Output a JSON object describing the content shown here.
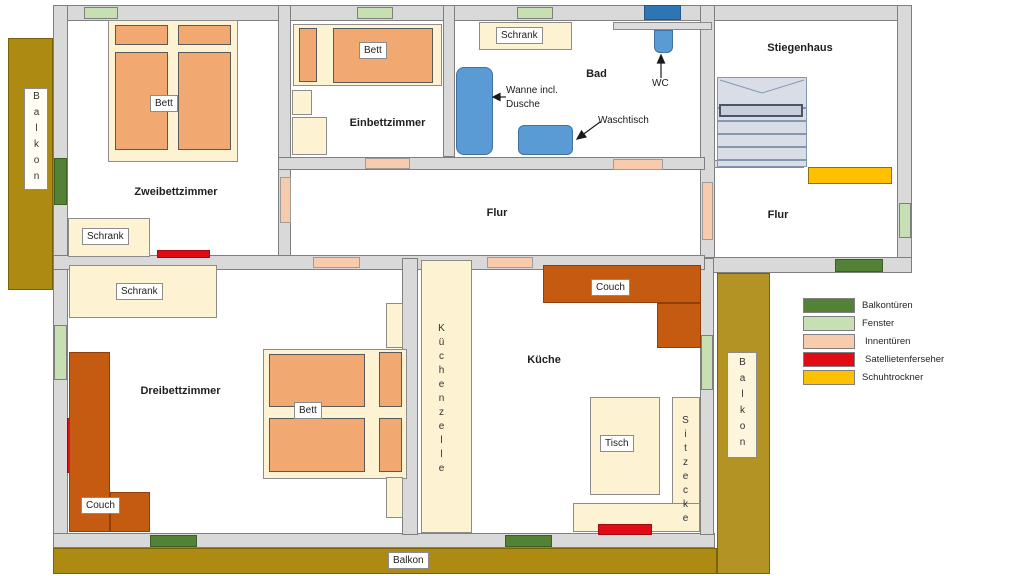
{
  "rooms": {
    "zweibettzimmer": "Zweibettzimmer",
    "einbettzimmer": "Einbettzimmer",
    "bad": "Bad",
    "stiegenhaus": "Stiegenhaus",
    "flur_mitte": "Flur",
    "flur_rechts": "Flur",
    "dreibettzimmer": "Dreibettzimmer",
    "kueche": "Küche"
  },
  "furniture_labels": {
    "bett": "Bett",
    "schrank": "Schrank",
    "couch": "Couch",
    "tisch": "Tisch",
    "kuechenzeile": "Küchenzelle",
    "sitzecke": "Sitzecke"
  },
  "annotations": {
    "wanne_line1": "Wanne incl.",
    "wanne_line2": "Dusche",
    "waschtisch": "Waschtisch",
    "wc": "WC"
  },
  "balkon_label": "Balkon",
  "legend": {
    "items": [
      {
        "label": "Balkontüren",
        "color": "#538135"
      },
      {
        "label": "Fenster",
        "color": "#c6e0b4"
      },
      {
        "label": "Innentüren",
        "color": "#f8cbad"
      },
      {
        "label": "Satellietenferseher",
        "color": "#e00b15"
      },
      {
        "label": "Schuhtrockner",
        "color": "#ffc000"
      }
    ]
  },
  "colors": {
    "wall": "#d9d9d9",
    "wall_border": "#7f7f7f",
    "furniture": "#fdf2d2",
    "mattress": "#f2a871",
    "balkon": "#ad8a12",
    "balkon_right": "#b49325",
    "couch": "#c55a11",
    "fixture_blue": "#5b9bd5",
    "wc_window_blue": "#2e75b6",
    "stairs": "#d9dee6"
  }
}
